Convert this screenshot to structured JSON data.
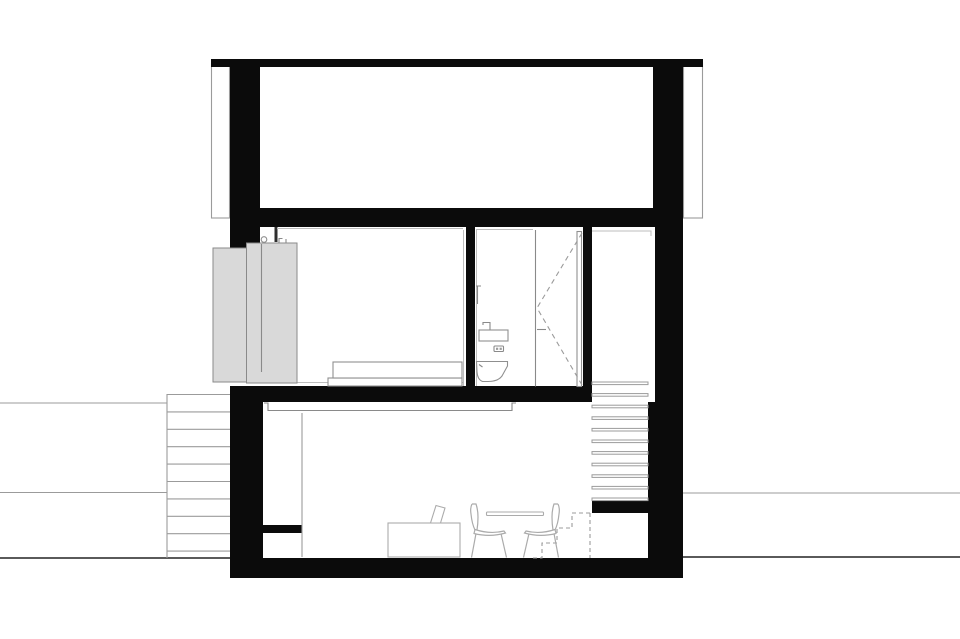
{
  "drawing": {
    "title": "building-cross-section",
    "type": "architectural-section-drawing",
    "background": "#ffffff",
    "colors": {
      "solid_wall": "#0b0b0b",
      "thin_line": "#9b9b9b",
      "light_line": "#bdbdbd",
      "medium_line": "#8a8a8a",
      "ground_line": "#5a5a5a",
      "shutter_fill": "#d9d9d9",
      "furniture_line": "#ababab"
    },
    "stairs": {
      "exterior_left": {
        "x1": 167,
        "x2": 230,
        "rail_x": 167,
        "rail_y1": 394,
        "rail_y2": 558,
        "y_start": 394.5,
        "step_dy": 17.4,
        "count": 10
      },
      "interior_upper": {
        "x1": 592,
        "x2": 648,
        "y_start": 382,
        "step_dy": 11.6,
        "tread_h": 2.6,
        "count": 11
      },
      "interior_lower_dashed": {
        "steps_path": "M590,513 H572 V528 H557 V543 H542 V558 H532",
        "right_edge_path": "M590,513 V558"
      }
    },
    "ground_lines": [
      {
        "x1": 0,
        "y": 403,
        "x2": 167,
        "w": 1
      },
      {
        "x1": 0,
        "y": 492.5,
        "x2": 167,
        "w": 1
      },
      {
        "x1": 0,
        "y": 558,
        "x2": 230,
        "w": 2
      },
      {
        "x1": 683,
        "y": 493,
        "x2": 960,
        "w": 1
      },
      {
        "x1": 683,
        "y": 557,
        "x2": 960,
        "w": 2
      }
    ]
  }
}
